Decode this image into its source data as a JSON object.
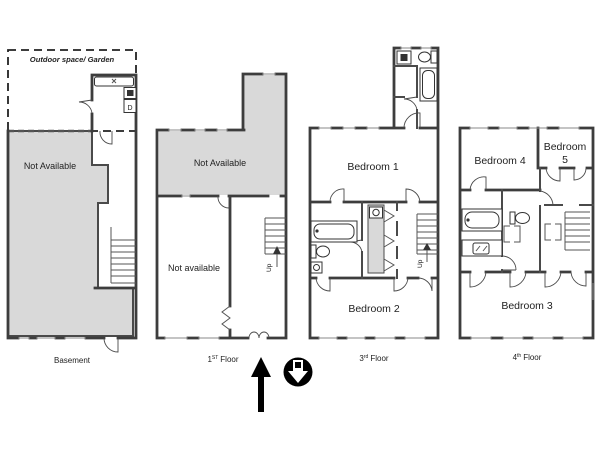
{
  "title": "4-floor apartment floor plan",
  "colors": {
    "wall": "#3d3d3d",
    "shaded_fill": "#d9d9d9",
    "background": "#ffffff",
    "arrow": "#000000"
  },
  "basement": {
    "outdoor_label": "Outdoor space/ Garden",
    "area_label": "Not Available",
    "dishwasher_label": "D",
    "floor_label": "Basement"
  },
  "first": {
    "upper_label": "Not Available",
    "lower_label": "Not available",
    "stairs_label": "Up",
    "floor_num": "1",
    "floor_sup": "ST",
    "floor_word": "Floor"
  },
  "third": {
    "bedroom1": "Bedroom 1",
    "bedroom2": "Bedroom 2",
    "stairs_label": "Up",
    "floor_num": "3",
    "floor_sup": "rd",
    "floor_word": "Floor"
  },
  "fourth": {
    "bedroom4": "Bedroom 4",
    "bedroom5_line1": "Bedroom",
    "bedroom5_line2": "5",
    "bedroom3": "Bedroom 3",
    "floor_num": "4",
    "floor_sup": "th",
    "floor_word": "Floor"
  },
  "icons": {
    "entrance_arrow": "up-arrow",
    "view_direction": "circle-with-down-arrow"
  }
}
